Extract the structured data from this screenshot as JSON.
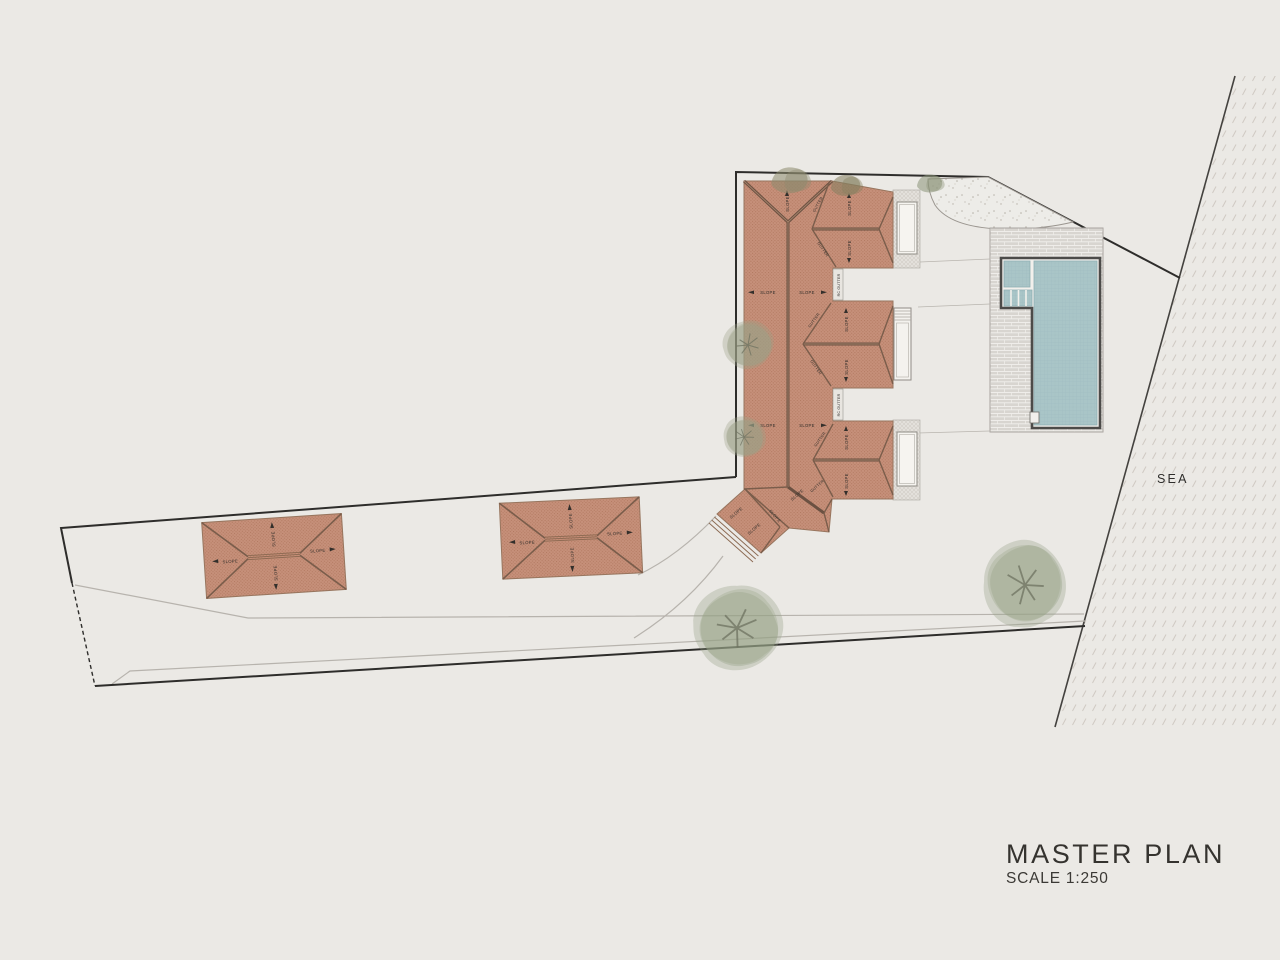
{
  "title_block": {
    "title": "MASTER PLAN",
    "scale": "SCALE 1:250"
  },
  "map_labels": {
    "sea": "SEA"
  },
  "roof_labels": {
    "slope": "SLOPE",
    "gutter": "GUTTER",
    "rc_gutter": "RC GUTTER"
  },
  "colors": {
    "background": "#ebe9e5",
    "roof_tile": "#c6907a",
    "roof_hatch": "#b1785f",
    "ridge_line": "#6b5142",
    "boundary_line": "#2e2d2b",
    "sea_line": "#44423f",
    "pool_water": "#a9c5c7",
    "deck_paving": "#d8d5d0",
    "sand": "#edece8",
    "tree_foliage": "#96a186",
    "shrub_foliage": "#8d8a6d",
    "road_edge": "#b7b3ad",
    "title_text": "#35332f"
  }
}
